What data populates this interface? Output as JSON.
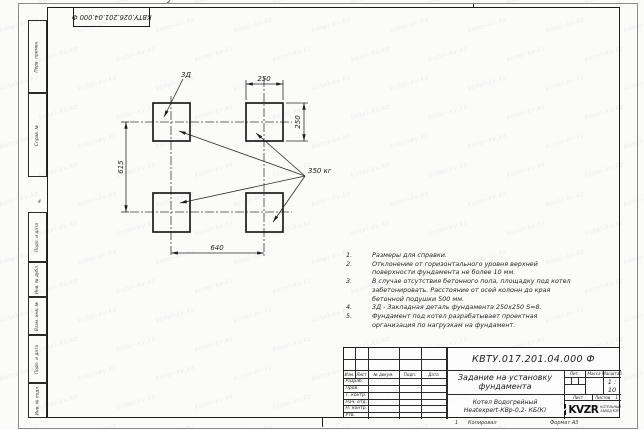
{
  "sheet": {
    "stamp_top": "КВТУ.026.201.04.000 Ф",
    "side_labels_top": [
      "Перв. примен.",
      "Справ. №"
    ],
    "side_labels_bottom": [
      "Подп. и дата",
      "Инв. № дубл.",
      "Взам. инв. №",
      "Подп. и дата",
      "Инв. № подл."
    ],
    "margin": {
      "top_mark": "2",
      "left_mark": "4",
      "bottom_num": "1",
      "copied": "Копировал",
      "format": "Формат А3"
    }
  },
  "drawing": {
    "dims": {
      "top": "250",
      "right": "250",
      "left": "615",
      "bottom": "640"
    },
    "labels": {
      "embed_part": "3Д",
      "load": "350 кг"
    }
  },
  "notes": [
    {
      "n": "1.",
      "t": "Размеры для справки."
    },
    {
      "n": "2.",
      "t": "Отклонение от горизонтального уровня верхней поверхности фундамента не более 10 мм."
    },
    {
      "n": "3.",
      "t": "В случае отсутствия бетонного пола, площадку под котел забетонировать. Расстояние от осей колонн до края бетонной подушки 500 мм."
    },
    {
      "n": "4.",
      "t": "3Д - Закладная деталь фундамента 250х250 S=8."
    },
    {
      "n": "5.",
      "t": "Фундамент под котел разрабатывает проектная организация по нагрузкам на фундамент."
    }
  ],
  "title_block": {
    "designation": "КВТУ.017.201.04.000 Ф",
    "doc_title_line1": "Задание на установку",
    "doc_title_line2": "фундамента",
    "product_line1": "Котел Водогрейный",
    "product_line2": "Heatexpert-КВр-0,2- КБ(К)",
    "header_cols": [
      "Изм.",
      "Лист",
      "№ докум.",
      "Подп.",
      "Дата"
    ],
    "sign_rows": [
      "Разраб.",
      "Пров.",
      "Т. контр.",
      "Нач. отд.",
      "Н. контр.",
      "Утв."
    ],
    "lit_label": "Лит.",
    "mass_label": "Масса",
    "scale_label": "Масштаб",
    "scale_value": "1 : 10",
    "sheet_label": "Лист",
    "sheets_label": "Листов",
    "sheets_value": "1",
    "logo_text": "KVZR",
    "company_line1": "КОТЕЛЬНЫЙ",
    "company_line2": "ЗАВОД КЗР"
  },
  "watermark": {
    "text": "kotel-kv.kz"
  }
}
